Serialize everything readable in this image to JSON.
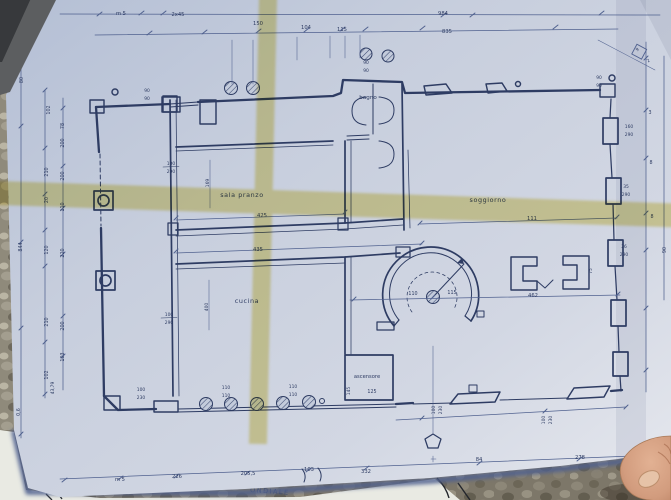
{
  "rooms": {
    "sala_pranzo": "sala pranzo",
    "soggiorno": "soggiorno",
    "cucina": "cucina",
    "bagno": "bagno",
    "ascensore": "ascensore"
  },
  "dims_top": {
    "m5": "m 5",
    "x45": "2x45",
    "d150": "150",
    "d104": "104",
    "d115": "115",
    "d984": "984",
    "d835": "835"
  },
  "dims_bottom": {
    "m5": "m 5",
    "d226": "226",
    "d205": "205,5",
    "d103": "103",
    "d332": "332",
    "d84": "84",
    "d278": "278"
  },
  "dims_left": {
    "d80": "80",
    "d102a": "102",
    "d78": "78",
    "d200a": "200",
    "d210a": "210",
    "d200b": "200",
    "d20": "20",
    "d110": "110",
    "d844": "844",
    "d120": "120",
    "d220": "220",
    "d210b": "210",
    "d200c": "200",
    "d103": "103",
    "d102b": "102",
    "d4379": "43,79",
    "d06": "0,6"
  },
  "dims_right": {
    "d3": "3",
    "d8a": "8",
    "d8b": "8",
    "d90": "90",
    "d9": "9",
    "d2": "2",
    "d75": "75"
  },
  "dims_interior": {
    "d425": "425",
    "d435": "435",
    "d111": "111",
    "d462": "462",
    "d110": "110",
    "d115": "115",
    "d125": "125",
    "d145": "145",
    "d169": "169",
    "d400": "400"
  },
  "fractions": {
    "l1": [
      "100",
      "290"
    ],
    "l2": [
      "100",
      "290"
    ],
    "t1": [
      "90",
      "90"
    ],
    "t2": [
      "90",
      "90"
    ],
    "t3": [
      "90",
      "90"
    ],
    "b0": [
      "100",
      "230"
    ],
    "b1": [
      "110",
      "110"
    ],
    "b2": [
      "110",
      "110"
    ],
    "b3": [
      "100",
      "230"
    ],
    "b4": [
      "100",
      "230"
    ],
    "r1": [
      "160",
      "290"
    ],
    "r2": [
      "35",
      "290"
    ],
    "r3": [
      "26",
      "290"
    ]
  },
  "understamp": {
    "text": "ONDIALE"
  },
  "colors": {
    "paper": "#c9d0de",
    "ink": "#2e3c63",
    "ink_light": "#50618f",
    "highlighter": "#ddcb57",
    "gravel": "#8f8a7b",
    "skin": "#d29c7e"
  }
}
